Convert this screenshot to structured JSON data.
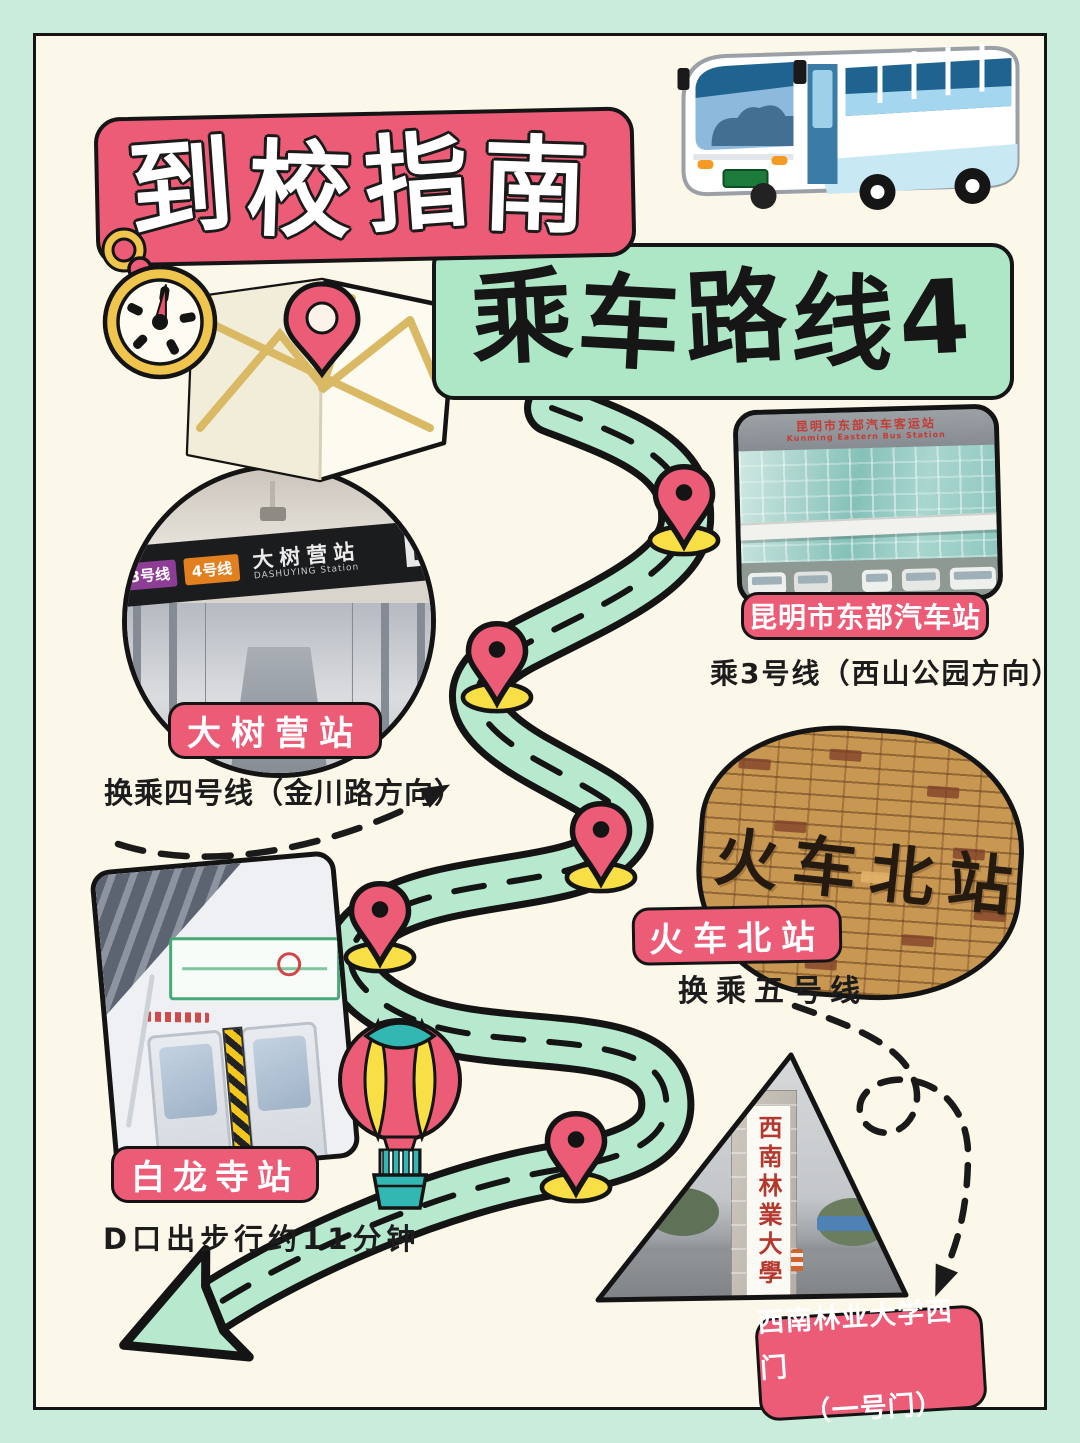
{
  "page": {
    "title": "到校指南",
    "subtitle": "乘车路线4"
  },
  "stations": {
    "east_bus": {
      "label": "昆明市东部汽车站",
      "note": "乘3号线（西山公园方向）",
      "sign_cn": "昆明市东部汽车客运站",
      "sign_en": "Kunming Eastern Bus Station"
    },
    "dashuying": {
      "label": "大树营站",
      "note": "换乘四号线（金川路方向）",
      "line3_badge": "3号线",
      "line4_badge": "4号线",
      "sign_cn": "大树营站",
      "sign_en": "DASHUYING Station",
      "exit_letter": "D"
    },
    "huochebei": {
      "label": "火车北站",
      "note": "换乘五号线",
      "sign": "火车北站"
    },
    "bailongsi": {
      "label": "白龙寺站",
      "note": "D口出步行约11分钟"
    },
    "gate": {
      "label": "西南林业大学西门",
      "label_line2": "（一号门）",
      "sign": "西南林業大學"
    }
  },
  "colors": {
    "pink": "#EC5C77",
    "mint": "#ADE7C5",
    "road_mint": "#B7E9CE",
    "page_mint": "#C9EDDA",
    "cream": "#FBF7E9",
    "yellow": "#F8DF45",
    "gold": "#EFC54D",
    "teal": "#33B7B2",
    "outline": "#1A1A1A"
  },
  "icons": [
    "bus-illustration",
    "stopwatch-icon",
    "map-icon",
    "map-pin-icon",
    "hot-air-balloon-icon",
    "route-road",
    "dashed-arrow"
  ]
}
